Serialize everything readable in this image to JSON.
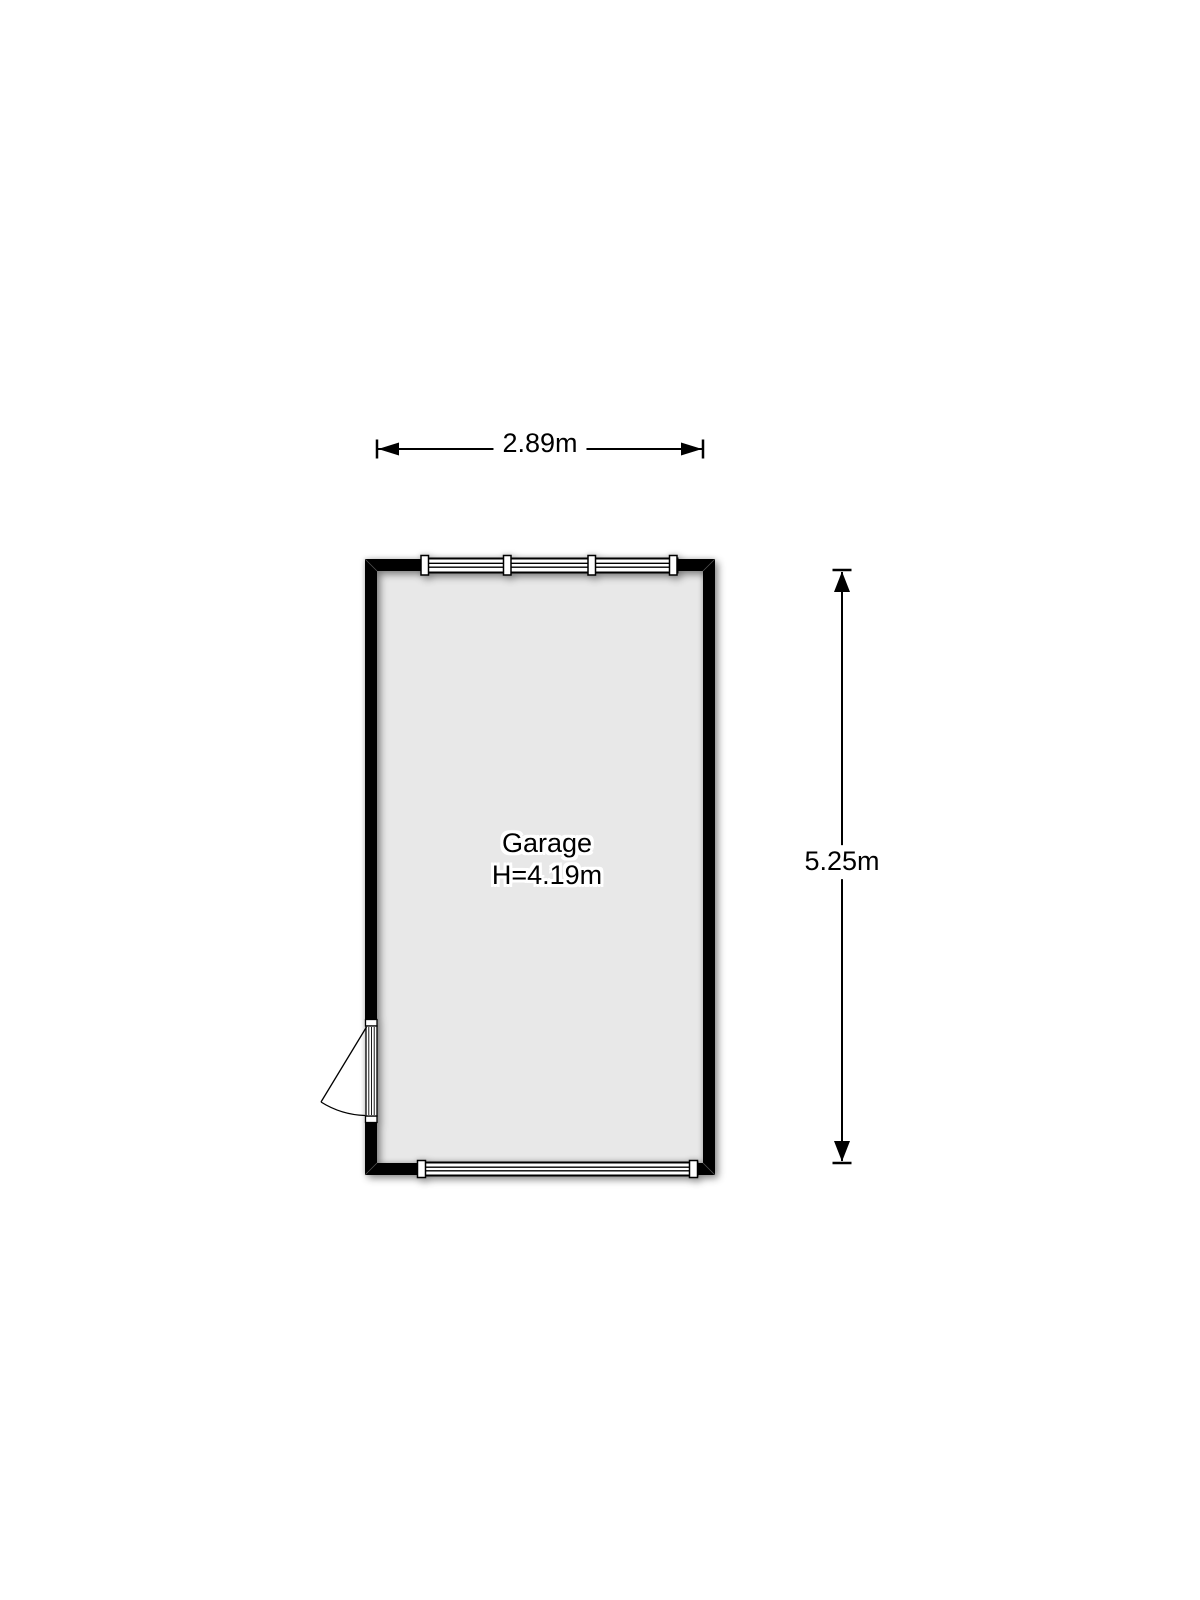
{
  "floorplan": {
    "room": {
      "name": "Garage",
      "ceiling_height": "H=4.19m",
      "floor_color": "#e8e8e8",
      "wall_color": "#000000"
    },
    "dimensions": {
      "width_label": "2.89m",
      "height_label": "5.25m"
    },
    "colors": {
      "background": "#ffffff",
      "line": "#000000",
      "window_fill": "#ffffff"
    }
  }
}
